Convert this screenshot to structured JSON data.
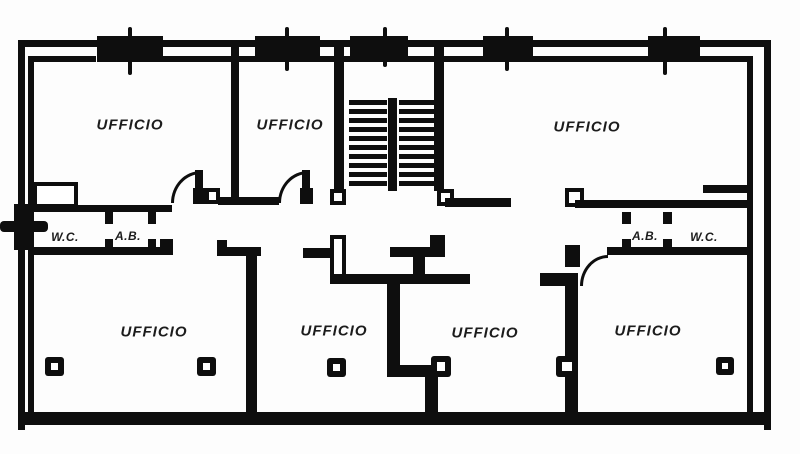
{
  "labels": {
    "offices": [
      "UFFICIO",
      "UFFICIO",
      "UFFICIO",
      "UFFICIO",
      "UFFICIO",
      "UFFICIO",
      "UFFICIO"
    ],
    "left_band": {
      "wc": "W.C.",
      "ab": "A.B."
    },
    "right_band": {
      "ab": "A.B.",
      "wc": "W.C."
    }
  },
  "colors": {
    "wall": "#0e0e0e",
    "background": "#ffffff",
    "text": "#1c1c1c"
  },
  "elements": {
    "staircase": "double-flight-stairs",
    "window_band": "ribbon-window",
    "pillar": "facade-pillar",
    "door": "door-swing-arc",
    "column": "structural-column-marker"
  }
}
